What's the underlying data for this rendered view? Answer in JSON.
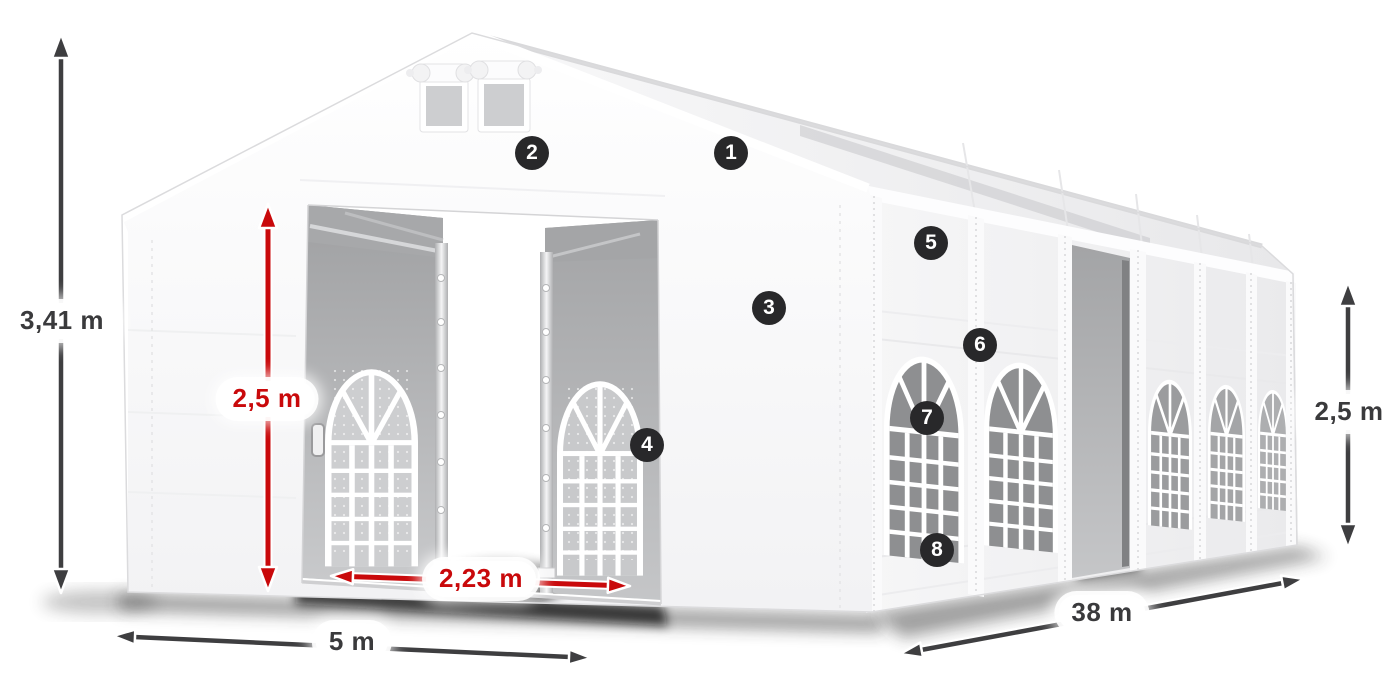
{
  "figure": {
    "subject": "White marquee tent shown in perspective with dimension annotations and numbered feature callouts"
  },
  "dimensions": {
    "total_height": {
      "label": "3,41 m",
      "style": "dark"
    },
    "entrance_height": {
      "label": "2,5 m",
      "style": "red"
    },
    "entrance_width": {
      "label": "2,23 m",
      "style": "red"
    },
    "front_width": {
      "label": "5 m",
      "style": "dark"
    },
    "side_length": {
      "label": "38 m",
      "style": "dark"
    },
    "side_height": {
      "label": "2,5 m",
      "style": "dark"
    }
  },
  "callouts": [
    "1",
    "2",
    "3",
    "4",
    "5",
    "6",
    "7",
    "8"
  ],
  "colors": {
    "background": "#ffffff",
    "arrow_dark": "#3e3e40",
    "arrow_red": "#c9090b",
    "badge_background": "#28282a",
    "badge_text": "#ffffff",
    "label_background": "#ffffff",
    "label_text_dark": "#3a3a3c",
    "label_text_red": "#c9090b",
    "tent_white": "#fbfbfc",
    "window_glass_gray": "#8e8f91"
  }
}
